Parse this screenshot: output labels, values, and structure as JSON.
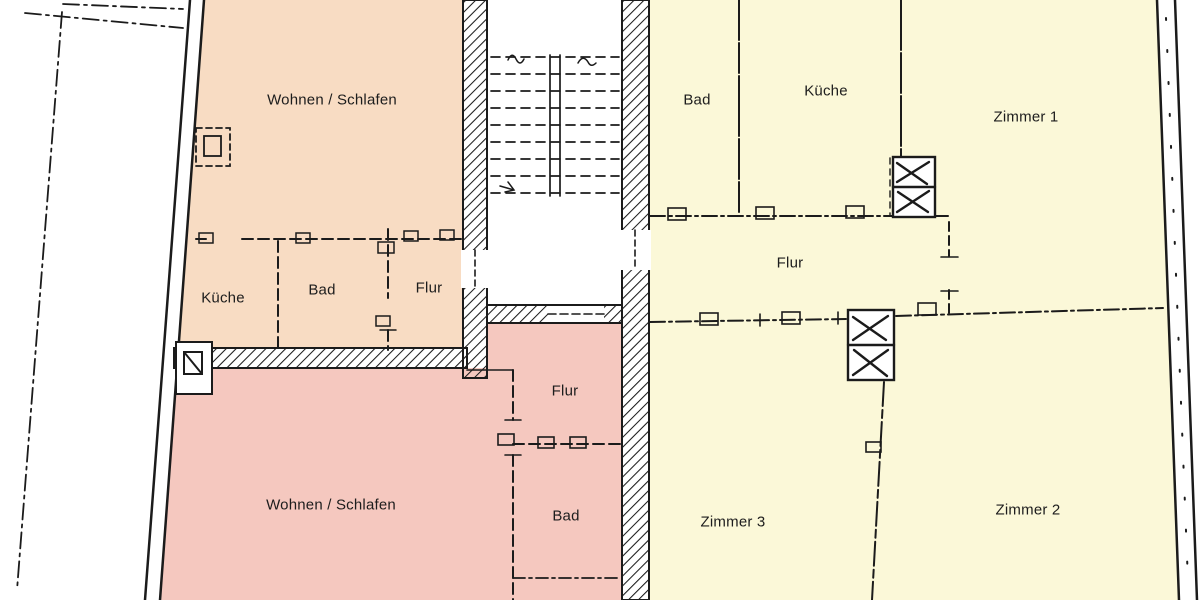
{
  "document": {
    "type": "floor-plan",
    "language": "de"
  },
  "palette": {
    "apartment_left_fill": "#f8dcc3",
    "apartment_bottom_fill": "#f5c8bf",
    "apartment_right_fill": "#fbf8d8",
    "ink": "#1b1b1b",
    "background": "#ffffff"
  },
  "rooms": [
    {
      "id": "apt-left-wohnen-schlafen",
      "label": "Wohnen / Schlafen"
    },
    {
      "id": "apt-left-kueche",
      "label": "Küche"
    },
    {
      "id": "apt-left-bad",
      "label": "Bad"
    },
    {
      "id": "apt-left-flur",
      "label": "Flur"
    },
    {
      "id": "apt-bottom-wohnen-schlafen",
      "label": "Wohnen / Schlafen"
    },
    {
      "id": "apt-bottom-flur",
      "label": "Flur"
    },
    {
      "id": "apt-bottom-bad",
      "label": "Bad"
    },
    {
      "id": "apt-right-bad",
      "label": "Bad"
    },
    {
      "id": "apt-right-kueche",
      "label": "Küche"
    },
    {
      "id": "apt-right-zimmer-1",
      "label": "Zimmer 1"
    },
    {
      "id": "apt-right-flur",
      "label": "Flur"
    },
    {
      "id": "apt-right-zimmer-3",
      "label": "Zimmer 3"
    },
    {
      "id": "apt-right-zimmer-2",
      "label": "Zimmer 2"
    }
  ],
  "features": [
    {
      "name": "staircase"
    },
    {
      "name": "chimney"
    },
    {
      "name": "ventilation-shaft"
    },
    {
      "name": "property-boundary-line"
    }
  ]
}
